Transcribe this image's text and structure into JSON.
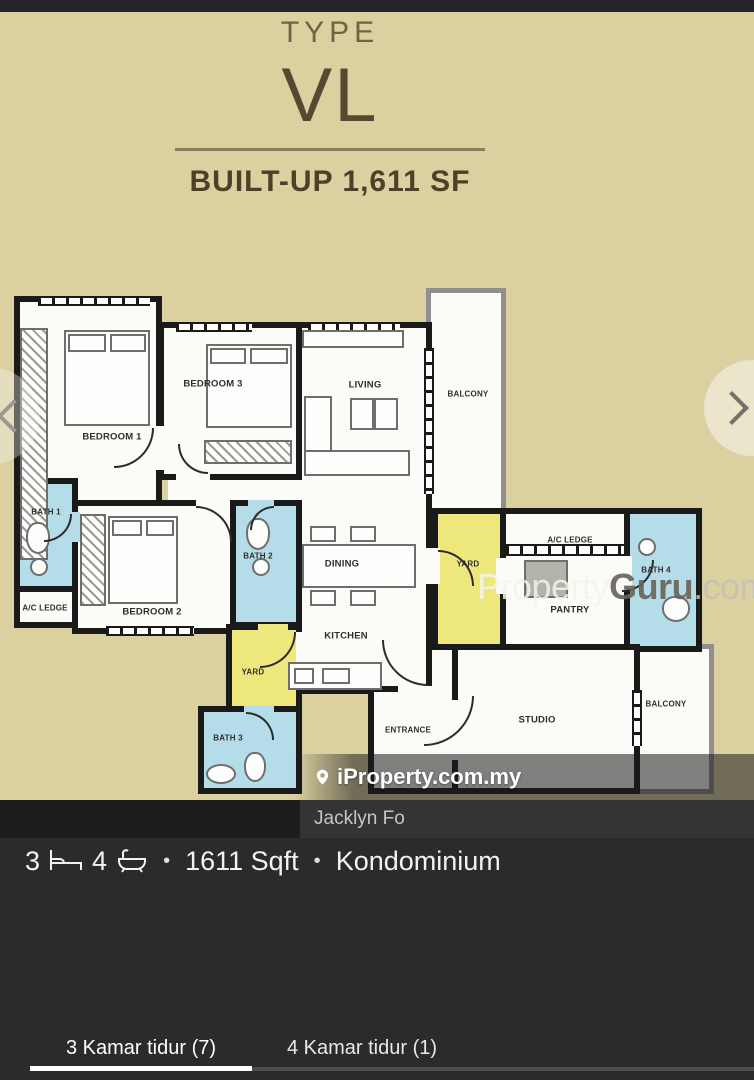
{
  "floorplan": {
    "title": {
      "type": "TYPE",
      "code": "VL",
      "builtup": "BUILT-UP 1,611 SF"
    },
    "rooms": {
      "bedroom1": "BEDROOM 1",
      "bedroom2": "BEDROOM 2",
      "bedroom3": "BEDROOM 3",
      "living": "LIVING",
      "dining": "DINING",
      "kitchen": "KITCHEN",
      "pantry": "PANTRY",
      "studio": "STUDIO",
      "entrance": "ENTRANCE",
      "bath1": "BATH 1",
      "bath2": "BATH 2",
      "bath3": "BATH 3",
      "bath4": "BATH 4",
      "yard_left": "YARD",
      "yard_right": "YARD",
      "acledge_left": "A/C LEDGE",
      "acledge_right": "A/C LEDGE",
      "balcony_top": "BALCONY",
      "balcony_right": "BALCONY"
    }
  },
  "watermarks": {
    "propertyguru": {
      "part1": "Property",
      "part2": "Guru",
      "part3": ".com.my"
    },
    "iproperty": "iProperty.com.my",
    "agent": "Jacklyn Fo"
  },
  "info": {
    "beds": "3",
    "baths": "4",
    "dot": "•",
    "area": "1611 Sqft",
    "property_type": "Kondominium"
  },
  "tabs": [
    {
      "label": "3 Kamar tidur (7)",
      "active": true
    },
    {
      "label": "4 Kamar tidur (1)",
      "active": false
    }
  ],
  "icons": {
    "beds": "bed-icon",
    "baths": "bathtub-icon",
    "brand": "location-pin-icon",
    "next": "chevron-right-icon",
    "prev": "chevron-left-icon"
  },
  "colors": {
    "plan_bg": "#dad0a0",
    "wall": "#1a1a1a",
    "bath_fill": "#b5dde9",
    "yard_fill": "#eee87c",
    "panel_bg": "#2b2b2b",
    "active_underline": "#ffffff"
  }
}
